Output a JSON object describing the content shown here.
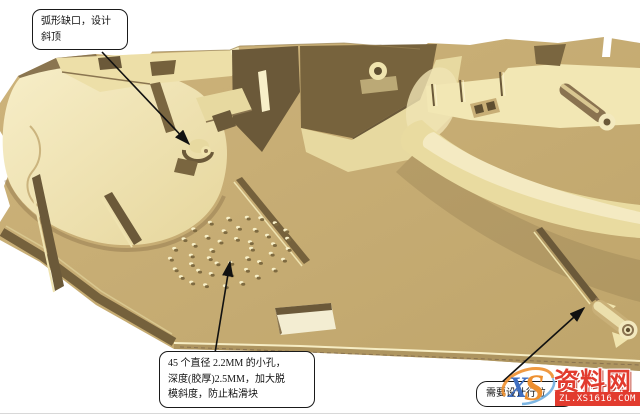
{
  "callouts": [
    {
      "id": "arc-notch",
      "text": "弧形缺口，设计\n斜顶"
    },
    {
      "id": "vent-holes",
      "text": "45 个直径 2.2MM 的小孔，\n深度(胶厚)2.5MM，加大脱\n模斜度，防止粘滑块"
    },
    {
      "id": "slider",
      "text": "需要设计行位"
    }
  ],
  "watermark": {
    "logo_x": "X",
    "logo_s": "S",
    "brand": "资料网",
    "url": "ZL.XS1616.COM",
    "brand_color": "#e23b2e",
    "logo_blue": "#3f6fc1",
    "logo_orange": "#ee8f2e"
  },
  "model": {
    "part_color": "#c6ac73",
    "highlight_color": "#f3e8bc",
    "shadow_color": "#6b5939",
    "background": "#ffffff",
    "hole_pattern": {
      "count": 45,
      "center_x": 231,
      "center_y": 252,
      "rings": [
        {
          "n": 21,
          "rx": 60,
          "ry": 33
        },
        {
          "n": 15,
          "rx": 42,
          "ry": 22
        },
        {
          "n": 9,
          "rx": 23,
          "ry": 12
        }
      ],
      "tilt_deg": -12
    }
  }
}
